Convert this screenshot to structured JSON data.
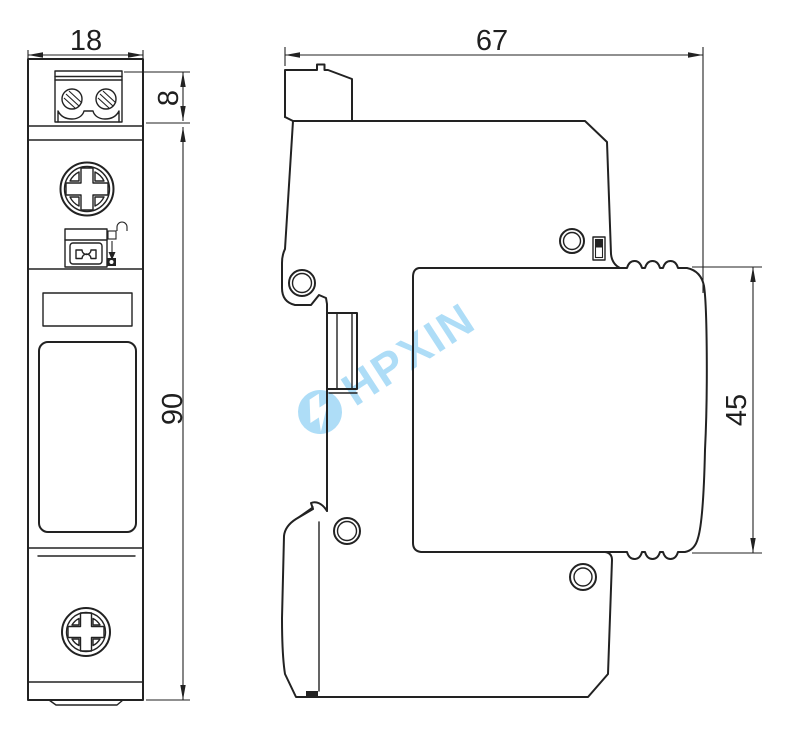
{
  "drawing": {
    "kind": "technical-dimension-drawing"
  },
  "dimensions": {
    "front_width": "18",
    "terminal_height": "8",
    "overall_height": "90",
    "overall_depth": "67",
    "module_height": "45"
  },
  "watermark": {
    "text": "HPXIN",
    "color": "#aeddf7"
  },
  "colors": {
    "line": "#222222",
    "background": "#ffffff"
  }
}
